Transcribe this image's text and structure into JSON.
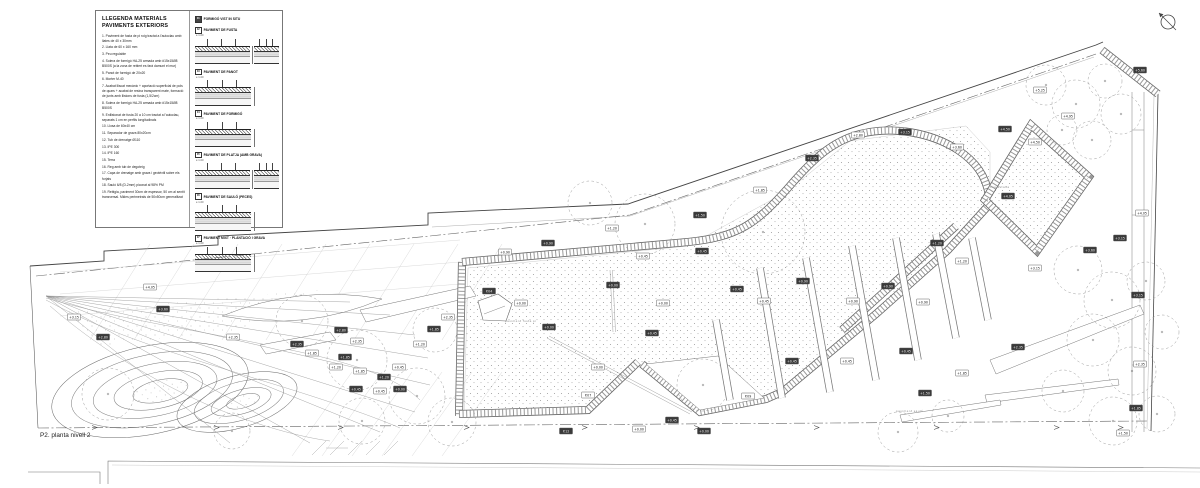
{
  "legend": {
    "title": "LLEGENDA MATERIALS PAVIMENTS EXTERIORS",
    "items": [
      "1. Paviment de fusta de pi roig tractat a l'autoclau amb llates de 40 x 30mm",
      "2. Llata de 60 x 160 mm",
      "3. Peu regulable",
      "4. Solera de formigó HA-25 armada amb #15x15Ø8 B500S (a la zona de reblert es farà damunt el mur)",
      "5. Panot de formigó de 20x20",
      "6. Morter M-40",
      "7. Acabat lliscat mecànic + aportació superficial de pols de quars + acabat de resina transparent mate, formació de junts amb llistons de fusta (1,5/2cm)",
      "8. Solera de formigó HA-25 armada amb #15x15Ø8 B500S",
      "9. Enllistonat de fusta 20 a 10 cm tractat a l'autoclau, separats 1 cm en perfils longitudinals",
      "10. Llosa de 60x40 cm",
      "11. Separador de grava 80x20cm",
      "12. Tub de drenatge Ø110",
      "13. IPE 300",
      "14. IPE 160",
      "15. Terra",
      "16. Reg amb tub de degoteig",
      "17. Capa de drenatge amb grava i geotèxtil sobre els forjats",
      "18. Sauló 6/8 (D-2mm) piconat al 98% PM",
      "19. Reblgia, paviment 30cm de espessor, 50 cm al sentit transversal. Mides perimetrals de 50x50cm generalitzat"
    ],
    "details": [
      {
        "num": "01",
        "title": "FORMIGÓ VIST IN SITU",
        "scale": "",
        "label_only": true,
        "dual": false
      },
      {
        "num": "02",
        "title": "PAVIMENT DE FUSTA",
        "scale": "e 1:20",
        "label_only": false,
        "dual": true
      },
      {
        "num": "03",
        "title": "PAVIMENT DE PANOT",
        "scale": "e 1:20",
        "label_only": false,
        "dual": false
      },
      {
        "num": "04",
        "title": "PAVIMENT DE FORMIGÓ",
        "scale": "e 1:20",
        "label_only": false,
        "dual": false
      },
      {
        "num": "05",
        "title": "PAVIMENT DE PLATJA (AMB GRAVA)",
        "scale": "e 1:20",
        "label_only": false,
        "dual": true
      },
      {
        "num": "06",
        "title": "PAVIMENT DE SAULÓ (PECES)",
        "scale": "e 1:20",
        "label_only": false,
        "dual": false
      },
      {
        "num": "07",
        "title": "PAVIMENT MIXT · PLANTACIÓ I GRAVA",
        "scale": "e 1:20",
        "label_only": false,
        "dual": false
      }
    ]
  },
  "plan": {
    "caption": "P2. planta nivell 2",
    "micro_labels": [
      [
        505,
        322,
        "paviment fusta pi"
      ],
      [
        988,
        188,
        "zona estada"
      ],
      [
        896,
        412,
        "paviment sauló"
      ]
    ],
    "markers": [
      [
        150,
        287,
        "+4.05",
        0
      ],
      [
        163,
        309,
        "+3.60",
        1
      ],
      [
        74,
        317,
        "+3.15",
        0
      ],
      [
        103,
        337,
        "+2.80",
        1
      ],
      [
        233,
        337,
        "+2.35",
        0
      ],
      [
        297,
        344,
        "+2.35",
        1
      ],
      [
        312,
        353,
        "+1.85",
        0
      ],
      [
        341,
        330,
        "+2.80",
        1
      ],
      [
        357,
        341,
        "+2.35",
        0
      ],
      [
        345,
        357,
        "+1.85",
        1
      ],
      [
        336,
        367,
        "+1.20",
        0
      ],
      [
        360,
        371,
        "+1.85",
        0
      ],
      [
        384,
        377,
        "+1.20",
        1
      ],
      [
        399,
        367,
        "+0.45",
        0
      ],
      [
        356,
        389,
        "+0.45",
        1
      ],
      [
        380,
        391,
        "+0.45",
        0
      ],
      [
        400,
        389,
        "+0.00",
        1
      ],
      [
        420,
        344,
        "+1.20",
        0
      ],
      [
        434,
        329,
        "+1.85",
        1
      ],
      [
        448,
        317,
        "+2.35",
        0
      ],
      [
        489,
        291,
        "P.04",
        1
      ],
      [
        521,
        303,
        "+0.00",
        0
      ],
      [
        549,
        327,
        "+0.00",
        1
      ],
      [
        598,
        367,
        "+0.00",
        0
      ],
      [
        652,
        333,
        "+0.45",
        1
      ],
      [
        588,
        395,
        "P.07",
        0
      ],
      [
        613,
        285,
        "+0.00",
        1
      ],
      [
        663,
        303,
        "+0.00",
        0
      ],
      [
        737,
        289,
        "+0.45",
        1
      ],
      [
        643,
        256,
        "+0.45",
        0
      ],
      [
        702,
        251,
        "+0.45",
        1
      ],
      [
        764,
        301,
        "+0.45",
        0
      ],
      [
        803,
        281,
        "+0.90",
        1
      ],
      [
        853,
        301,
        "+0.90",
        0
      ],
      [
        888,
        286,
        "+0.90",
        1
      ],
      [
        923,
        302,
        "+0.90",
        0
      ],
      [
        937,
        243,
        "+1.20",
        1
      ],
      [
        962,
        261,
        "+1.20",
        0
      ],
      [
        906,
        351,
        "+0.45",
        1
      ],
      [
        847,
        361,
        "+0.45",
        0
      ],
      [
        792,
        361,
        "+0.45",
        1
      ],
      [
        748,
        396,
        "P.09",
        0
      ],
      [
        704,
        431,
        "+0.00",
        1
      ],
      [
        639,
        429,
        "+0.00",
        0
      ],
      [
        566,
        431,
        "P.12",
        1
      ],
      [
        612,
        228,
        "+1.20",
        0
      ],
      [
        548,
        243,
        "+0.90",
        1
      ],
      [
        505,
        252,
        "+0.90",
        0
      ],
      [
        700,
        215,
        "+1.50",
        1
      ],
      [
        760,
        190,
        "+1.85",
        0
      ],
      [
        812,
        158,
        "+2.35",
        1
      ],
      [
        858,
        135,
        "+2.80",
        0
      ],
      [
        905,
        132,
        "+3.15",
        1
      ],
      [
        957,
        147,
        "+3.60",
        0
      ],
      [
        1008,
        196,
        "+4.05",
        1
      ],
      [
        1035,
        142,
        "+4.50",
        0
      ],
      [
        1005,
        129,
        "+4.50",
        1
      ],
      [
        1068,
        116,
        "+4.95",
        0
      ],
      [
        1090,
        250,
        "+3.60",
        1
      ],
      [
        1035,
        268,
        "+3.15",
        0
      ],
      [
        1120,
        238,
        "+3.15",
        1
      ],
      [
        1040,
        90,
        "+5.25",
        0
      ],
      [
        1140,
        70,
        "+5.60",
        1
      ],
      [
        1142,
        213,
        "+4.05",
        0
      ],
      [
        1138,
        295,
        "+3.15",
        1
      ],
      [
        1140,
        364,
        "+2.35",
        0
      ],
      [
        1136,
        408,
        "+1.85",
        1
      ],
      [
        1123,
        433,
        "+1.50",
        0
      ],
      [
        1018,
        347,
        "+2.35",
        1
      ],
      [
        962,
        373,
        "+1.85",
        0
      ],
      [
        925,
        393,
        "+1.50",
        1
      ],
      [
        672,
        420,
        "+0.45",
        1
      ]
    ],
    "trees": [
      [
        763,
        232,
        42
      ],
      [
        645,
        224,
        30
      ],
      [
        590,
        203,
        22
      ],
      [
        703,
        385,
        26
      ],
      [
        1046,
        85,
        20
      ],
      [
        1076,
        104,
        24
      ],
      [
        1105,
        81,
        17
      ],
      [
        1121,
        114,
        20
      ],
      [
        1062,
        130,
        15
      ],
      [
        1092,
        140,
        19
      ],
      [
        1078,
        270,
        24
      ],
      [
        1112,
        300,
        28
      ],
      [
        1146,
        281,
        19
      ],
      [
        1093,
        340,
        26
      ],
      [
        1132,
        371,
        24
      ],
      [
        1162,
        332,
        17
      ],
      [
        1063,
        391,
        21
      ],
      [
        1113,
        421,
        24
      ],
      [
        1157,
        414,
        18
      ],
      [
        898,
        432,
        20
      ],
      [
        948,
        416,
        16
      ],
      [
        302,
        321,
        26
      ],
      [
        357,
        360,
        30
      ],
      [
        417,
        396,
        28
      ],
      [
        362,
        421,
        23
      ],
      [
        108,
        394,
        26
      ],
      [
        232,
        431,
        18
      ],
      [
        452,
        422,
        24
      ],
      [
        435,
        330,
        22
      ]
    ],
    "slats": [
      [
        760,
        268,
        782,
        398
      ],
      [
        806,
        258,
        830,
        392
      ],
      [
        852,
        246,
        876,
        380
      ],
      [
        896,
        238,
        918,
        360
      ],
      [
        936,
        234,
        956,
        338
      ],
      [
        972,
        238,
        988,
        320
      ],
      [
        716,
        320,
        730,
        400
      ]
    ],
    "fan_lines": [
      [
        46,
        296,
        350,
        302
      ],
      [
        46,
        296,
        390,
        315
      ],
      [
        46,
        296,
        415,
        335
      ],
      [
        46,
        296,
        428,
        358
      ],
      [
        46,
        296,
        430,
        385
      ],
      [
        46,
        296,
        415,
        412
      ],
      [
        46,
        296,
        380,
        432
      ],
      [
        46,
        296,
        310,
        443
      ],
      [
        46,
        296,
        230,
        443
      ]
    ],
    "arrow_xs": [
      92,
      214,
      338,
      464,
      582,
      694,
      814,
      934,
      1054,
      1118
    ]
  },
  "colors": {
    "line": "#444",
    "band_edge": "#666",
    "band_rung": "#999",
    "stipple": "#9a9a9a",
    "faint": "#c4c4c4"
  }
}
